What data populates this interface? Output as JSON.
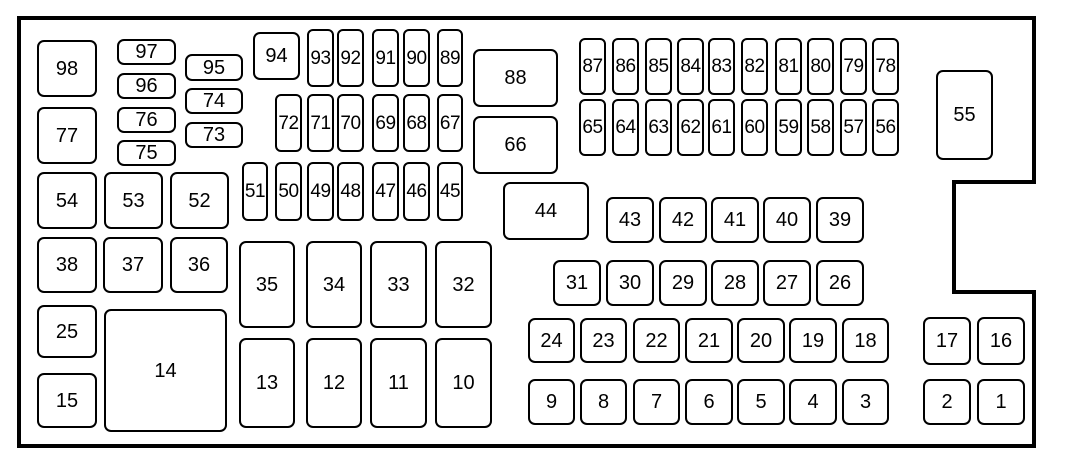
{
  "diagram": {
    "name": "fuse-panel-diagram",
    "canvas": {
      "width": 1071,
      "height": 472,
      "background": "#ffffff"
    },
    "style": {
      "stroke": "#000000",
      "box_fill": "#ffffff",
      "outline_stroke_width": 4,
      "box_stroke_width": 2
    },
    "outline": {
      "points": [
        [
          19,
          18
        ],
        [
          1034,
          18
        ],
        [
          1034,
          182
        ],
        [
          954,
          182
        ],
        [
          954,
          292
        ],
        [
          1034,
          292
        ],
        [
          1034,
          446
        ],
        [
          19,
          446
        ]
      ]
    },
    "boxes": [
      {
        "label": "98",
        "x": 37,
        "y": 40,
        "w": 60,
        "h": 57
      },
      {
        "label": "97",
        "x": 117,
        "y": 39,
        "w": 59,
        "h": 26
      },
      {
        "label": "96",
        "x": 117,
        "y": 73,
        "w": 59,
        "h": 26
      },
      {
        "label": "76",
        "x": 117,
        "y": 107,
        "w": 59,
        "h": 26
      },
      {
        "label": "75",
        "x": 117,
        "y": 140,
        "w": 59,
        "h": 26
      },
      {
        "label": "95",
        "x": 185,
        "y": 54,
        "w": 58,
        "h": 27
      },
      {
        "label": "74",
        "x": 185,
        "y": 88,
        "w": 58,
        "h": 26
      },
      {
        "label": "73",
        "x": 185,
        "y": 122,
        "w": 58,
        "h": 26
      },
      {
        "label": "77",
        "x": 37,
        "y": 107,
        "w": 60,
        "h": 57
      },
      {
        "label": "94",
        "x": 253,
        "y": 32,
        "w": 47,
        "h": 48
      },
      {
        "label": "93",
        "x": 307,
        "y": 29,
        "w": 27,
        "h": 58
      },
      {
        "label": "92",
        "x": 337,
        "y": 29,
        "w": 27,
        "h": 58
      },
      {
        "label": "91",
        "x": 372,
        "y": 29,
        "w": 27,
        "h": 58
      },
      {
        "label": "90",
        "x": 403,
        "y": 29,
        "w": 27,
        "h": 58
      },
      {
        "label": "89",
        "x": 437,
        "y": 29,
        "w": 26,
        "h": 58
      },
      {
        "label": "88",
        "x": 473,
        "y": 49,
        "w": 85,
        "h": 58
      },
      {
        "label": "87",
        "x": 579,
        "y": 38,
        "w": 27,
        "h": 57
      },
      {
        "label": "86",
        "x": 612,
        "y": 38,
        "w": 27,
        "h": 57
      },
      {
        "label": "85",
        "x": 645,
        "y": 38,
        "w": 27,
        "h": 57
      },
      {
        "label": "84",
        "x": 677,
        "y": 38,
        "w": 27,
        "h": 57
      },
      {
        "label": "83",
        "x": 708,
        "y": 38,
        "w": 27,
        "h": 57
      },
      {
        "label": "82",
        "x": 741,
        "y": 38,
        "w": 27,
        "h": 57
      },
      {
        "label": "81",
        "x": 775,
        "y": 38,
        "w": 27,
        "h": 57
      },
      {
        "label": "80",
        "x": 807,
        "y": 38,
        "w": 27,
        "h": 57
      },
      {
        "label": "79",
        "x": 840,
        "y": 38,
        "w": 27,
        "h": 57
      },
      {
        "label": "78",
        "x": 872,
        "y": 38,
        "w": 27,
        "h": 57
      },
      {
        "label": "55",
        "x": 936,
        "y": 70,
        "w": 57,
        "h": 90
      },
      {
        "label": "72",
        "x": 275,
        "y": 94,
        "w": 27,
        "h": 58
      },
      {
        "label": "71",
        "x": 307,
        "y": 94,
        "w": 27,
        "h": 58
      },
      {
        "label": "70",
        "x": 337,
        "y": 94,
        "w": 27,
        "h": 58
      },
      {
        "label": "69",
        "x": 372,
        "y": 94,
        "w": 27,
        "h": 58
      },
      {
        "label": "68",
        "x": 403,
        "y": 94,
        "w": 27,
        "h": 58
      },
      {
        "label": "67",
        "x": 437,
        "y": 94,
        "w": 26,
        "h": 58
      },
      {
        "label": "66",
        "x": 473,
        "y": 116,
        "w": 85,
        "h": 58
      },
      {
        "label": "65",
        "x": 579,
        "y": 99,
        "w": 27,
        "h": 57
      },
      {
        "label": "64",
        "x": 612,
        "y": 99,
        "w": 27,
        "h": 57
      },
      {
        "label": "63",
        "x": 645,
        "y": 99,
        "w": 27,
        "h": 57
      },
      {
        "label": "62",
        "x": 677,
        "y": 99,
        "w": 27,
        "h": 57
      },
      {
        "label": "61",
        "x": 708,
        "y": 99,
        "w": 27,
        "h": 57
      },
      {
        "label": "60",
        "x": 741,
        "y": 99,
        "w": 27,
        "h": 57
      },
      {
        "label": "59",
        "x": 775,
        "y": 99,
        "w": 27,
        "h": 57
      },
      {
        "label": "58",
        "x": 807,
        "y": 99,
        "w": 27,
        "h": 57
      },
      {
        "label": "57",
        "x": 840,
        "y": 99,
        "w": 27,
        "h": 57
      },
      {
        "label": "56",
        "x": 872,
        "y": 99,
        "w": 27,
        "h": 57
      },
      {
        "label": "54",
        "x": 37,
        "y": 172,
        "w": 60,
        "h": 57
      },
      {
        "label": "53",
        "x": 104,
        "y": 172,
        "w": 59,
        "h": 57
      },
      {
        "label": "52",
        "x": 170,
        "y": 172,
        "w": 59,
        "h": 57
      },
      {
        "label": "51",
        "x": 242,
        "y": 162,
        "w": 26,
        "h": 59
      },
      {
        "label": "50",
        "x": 275,
        "y": 162,
        "w": 27,
        "h": 59
      },
      {
        "label": "49",
        "x": 307,
        "y": 162,
        "w": 27,
        "h": 59
      },
      {
        "label": "48",
        "x": 337,
        "y": 162,
        "w": 27,
        "h": 59
      },
      {
        "label": "47",
        "x": 372,
        "y": 162,
        "w": 27,
        "h": 59
      },
      {
        "label": "46",
        "x": 403,
        "y": 162,
        "w": 27,
        "h": 59
      },
      {
        "label": "45",
        "x": 437,
        "y": 162,
        "w": 26,
        "h": 59
      },
      {
        "label": "44",
        "x": 503,
        "y": 182,
        "w": 86,
        "h": 58
      },
      {
        "label": "43",
        "x": 606,
        "y": 197,
        "w": 48,
        "h": 46
      },
      {
        "label": "42",
        "x": 659,
        "y": 197,
        "w": 48,
        "h": 46
      },
      {
        "label": "41",
        "x": 711,
        "y": 197,
        "w": 48,
        "h": 46
      },
      {
        "label": "40",
        "x": 763,
        "y": 197,
        "w": 48,
        "h": 46
      },
      {
        "label": "39",
        "x": 816,
        "y": 197,
        "w": 48,
        "h": 46
      },
      {
        "label": "38",
        "x": 37,
        "y": 237,
        "w": 60,
        "h": 56
      },
      {
        "label": "37",
        "x": 103,
        "y": 237,
        "w": 60,
        "h": 56
      },
      {
        "label": "36",
        "x": 170,
        "y": 237,
        "w": 58,
        "h": 56
      },
      {
        "label": "35",
        "x": 239,
        "y": 241,
        "w": 56,
        "h": 87
      },
      {
        "label": "34",
        "x": 306,
        "y": 241,
        "w": 56,
        "h": 87
      },
      {
        "label": "33",
        "x": 370,
        "y": 241,
        "w": 57,
        "h": 87
      },
      {
        "label": "32",
        "x": 435,
        "y": 241,
        "w": 57,
        "h": 87
      },
      {
        "label": "31",
        "x": 553,
        "y": 260,
        "w": 48,
        "h": 46
      },
      {
        "label": "30",
        "x": 606,
        "y": 260,
        "w": 48,
        "h": 46
      },
      {
        "label": "29",
        "x": 659,
        "y": 260,
        "w": 48,
        "h": 46
      },
      {
        "label": "28",
        "x": 711,
        "y": 260,
        "w": 48,
        "h": 46
      },
      {
        "label": "27",
        "x": 763,
        "y": 260,
        "w": 48,
        "h": 46
      },
      {
        "label": "26",
        "x": 816,
        "y": 260,
        "w": 48,
        "h": 46
      },
      {
        "label": "25",
        "x": 37,
        "y": 305,
        "w": 60,
        "h": 53
      },
      {
        "label": "24",
        "x": 528,
        "y": 318,
        "w": 47,
        "h": 45
      },
      {
        "label": "23",
        "x": 580,
        "y": 318,
        "w": 47,
        "h": 45
      },
      {
        "label": "22",
        "x": 633,
        "y": 318,
        "w": 47,
        "h": 45
      },
      {
        "label": "21",
        "x": 685,
        "y": 318,
        "w": 48,
        "h": 45
      },
      {
        "label": "20",
        "x": 737,
        "y": 318,
        "w": 48,
        "h": 45
      },
      {
        "label": "19",
        "x": 789,
        "y": 318,
        "w": 48,
        "h": 45
      },
      {
        "label": "18",
        "x": 842,
        "y": 318,
        "w": 47,
        "h": 45
      },
      {
        "label": "17",
        "x": 923,
        "y": 317,
        "w": 48,
        "h": 48
      },
      {
        "label": "16",
        "x": 977,
        "y": 317,
        "w": 48,
        "h": 48
      },
      {
        "label": "15",
        "x": 37,
        "y": 373,
        "w": 60,
        "h": 55
      },
      {
        "label": "14",
        "x": 104,
        "y": 309,
        "w": 123,
        "h": 123
      },
      {
        "label": "13",
        "x": 239,
        "y": 338,
        "w": 56,
        "h": 90
      },
      {
        "label": "12",
        "x": 306,
        "y": 338,
        "w": 56,
        "h": 90
      },
      {
        "label": "11",
        "x": 370,
        "y": 338,
        "w": 57,
        "h": 90
      },
      {
        "label": "10",
        "x": 435,
        "y": 338,
        "w": 57,
        "h": 90
      },
      {
        "label": "9",
        "x": 528,
        "y": 379,
        "w": 47,
        "h": 46
      },
      {
        "label": "8",
        "x": 580,
        "y": 379,
        "w": 47,
        "h": 46
      },
      {
        "label": "7",
        "x": 633,
        "y": 379,
        "w": 47,
        "h": 46
      },
      {
        "label": "6",
        "x": 685,
        "y": 379,
        "w": 48,
        "h": 46
      },
      {
        "label": "5",
        "x": 737,
        "y": 379,
        "w": 48,
        "h": 46
      },
      {
        "label": "4",
        "x": 789,
        "y": 379,
        "w": 48,
        "h": 46
      },
      {
        "label": "3",
        "x": 842,
        "y": 379,
        "w": 47,
        "h": 46
      },
      {
        "label": "2",
        "x": 923,
        "y": 379,
        "w": 48,
        "h": 46
      },
      {
        "label": "1",
        "x": 977,
        "y": 379,
        "w": 48,
        "h": 46
      }
    ]
  }
}
